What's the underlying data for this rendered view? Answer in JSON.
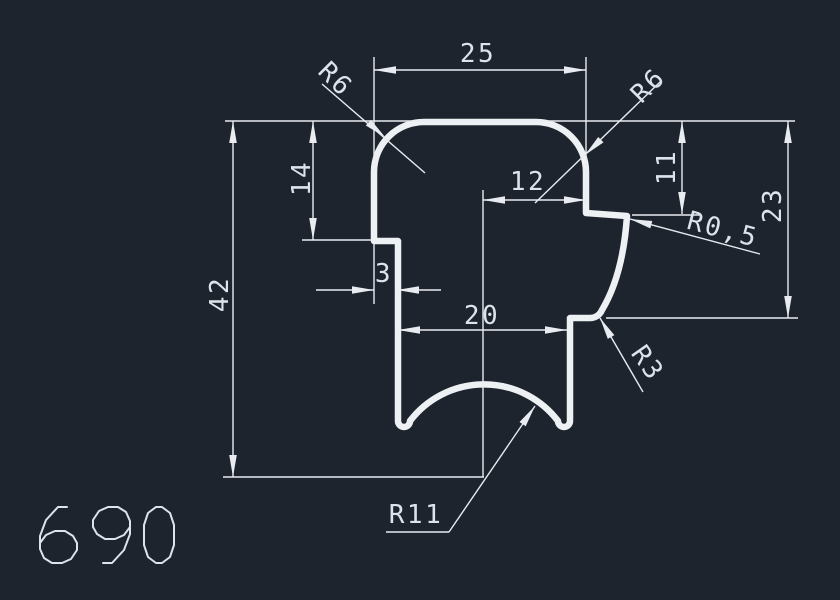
{
  "app": {
    "type": "cad-drawing-canvas"
  },
  "canvas": {
    "background_color": "#1e242e",
    "geometry_line_color": "#eef1f4",
    "dimension_line_color": "#e8ecf1"
  },
  "dimensions": {
    "top_width": "25",
    "fillet_top_left": "R6",
    "fillet_top_right": "R6",
    "left_upper_depth": "14",
    "overall_height": "42",
    "center_offset": "12",
    "right_lip_depth": "11",
    "right_shoulder_depth": "23",
    "lip_fillet": "R0,5",
    "left_step_width": "3",
    "leg_span": "20",
    "shoulder_fillet": "R3",
    "arch_radius": "R11"
  },
  "footer": {
    "drawing_number": "690"
  }
}
